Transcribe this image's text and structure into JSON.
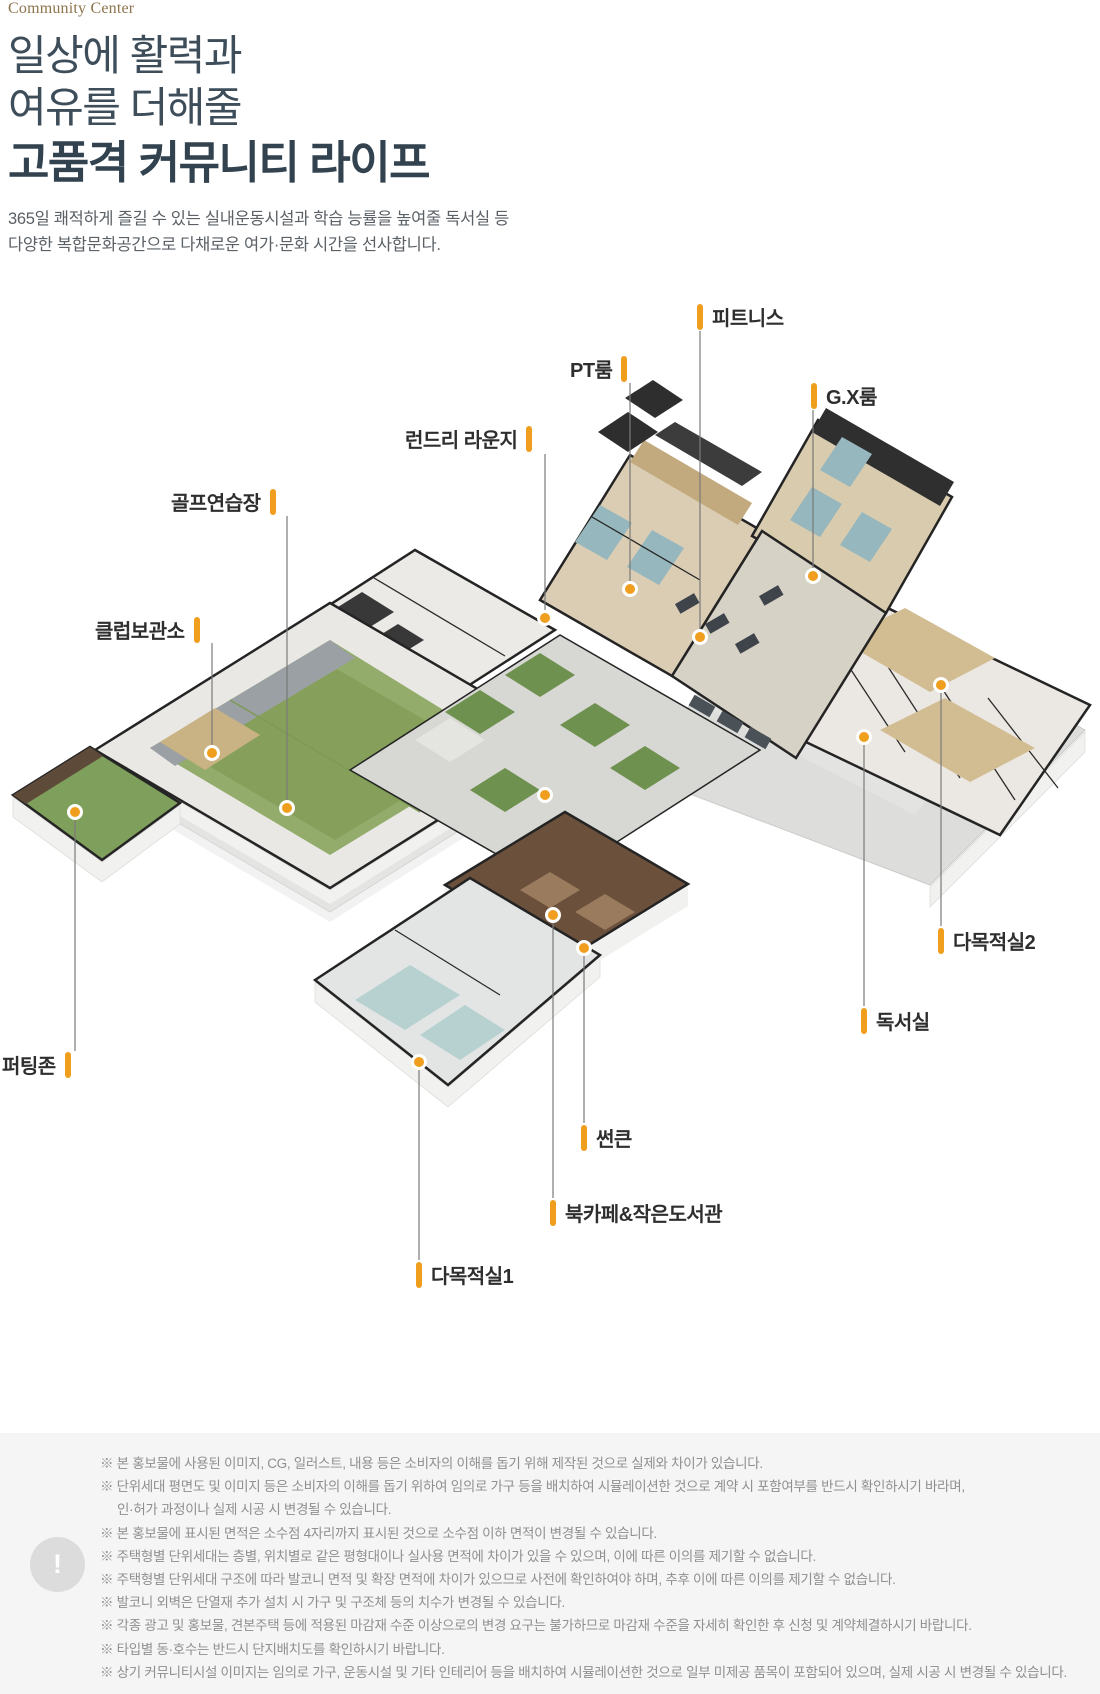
{
  "header": {
    "eyebrow": "Community Center",
    "title_line1": "일상에 활력과",
    "title_line2": "여유를 더해줄",
    "title_line3": "고품격 커뮤니티 라이프",
    "desc_line1": "365일 쾌적하게 즐길 수 있는 실내운동시설과 학습 능률을 높여줄 독서실 등",
    "desc_line2": "다양한 복합문화공간으로 다채로운 여가·문화 시간을 선사합니다."
  },
  "colors": {
    "accent_orange": "#F09E1D",
    "heading": "#3D4D5A",
    "eyebrow_brown": "#8D744C",
    "label_text": "#2E2E2E",
    "disclaimer_bg": "#F5F5F6",
    "disclaimer_text": "#8F8F8F"
  },
  "facilities": [
    {
      "label": "피트니스"
    },
    {
      "label": "PT룸"
    },
    {
      "label": "G.X룸"
    },
    {
      "label": "런드리 라운지"
    },
    {
      "label": "골프연습장"
    },
    {
      "label": "클럽보관소"
    },
    {
      "label": "다목적실2"
    },
    {
      "label": "독서실"
    },
    {
      "label": "퍼팅존"
    },
    {
      "label": "썬큰"
    },
    {
      "label": "북카페&작은도서관"
    },
    {
      "label": "다목적실1"
    }
  ],
  "disclaimer": {
    "icon": "!",
    "lines": [
      "※ 본 홍보물에 사용된 이미지, CG, 일러스트, 내용 등은 소비자의 이해를 돕기 위해 제작된 것으로 실제와 차이가 있습니다.",
      "※ 단위세대 평면도 및 이미지 등은 소비자의 이해를 돕기 위하여 임의로 가구 등을 배치하여 시뮬레이션한 것으로 계약 시 포함여부를 반드시 확인하시기 바라며,",
      "인·허가 과정이나 실제 시공 시 변경될 수 있습니다.",
      "※ 본 홍보물에 표시된 면적은 소수점 4자리까지 표시된 것으로 소수점 이하 면적이 변경될 수 있습니다.",
      "※ 주택형별 단위세대는 층별, 위치별로 같은 평형대이나 실사용 면적에 차이가 있을 수 있으며, 이에 따른 이의를 제기할 수 없습니다.",
      "※ 주택형별 단위세대 구조에 따라 발코니 면적 및 확장 면적에 차이가 있으므로 사전에 확인하여야 하며, 추후 이에 따른 이의를 제기할 수 없습니다.",
      "※ 발코니 외벽은 단열재 추가 설치 시 가구 및 구조체 등의 치수가 변경될 수 있습니다.",
      "※ 각종 광고 및 홍보물, 견본주택 등에 적용된 마감재 수준 이상으로의 변경 요구는 불가하므로 마감재 수준을 자세히 확인한 후 신청 및 계약체결하시기 바랍니다.",
      "※ 타입별 동·호수는 반드시 단지배치도를 확인하시기 바랍니다.",
      "※ 상기 커뮤니티시설 이미지는 임의로 가구, 운동시설 및 기타 인테리어 등을 배치하여 시뮬레이션한 것으로 일부 미제공 품목이 포함되어 있으며, 실제 시공 시 변경될 수 있습니다."
    ]
  }
}
